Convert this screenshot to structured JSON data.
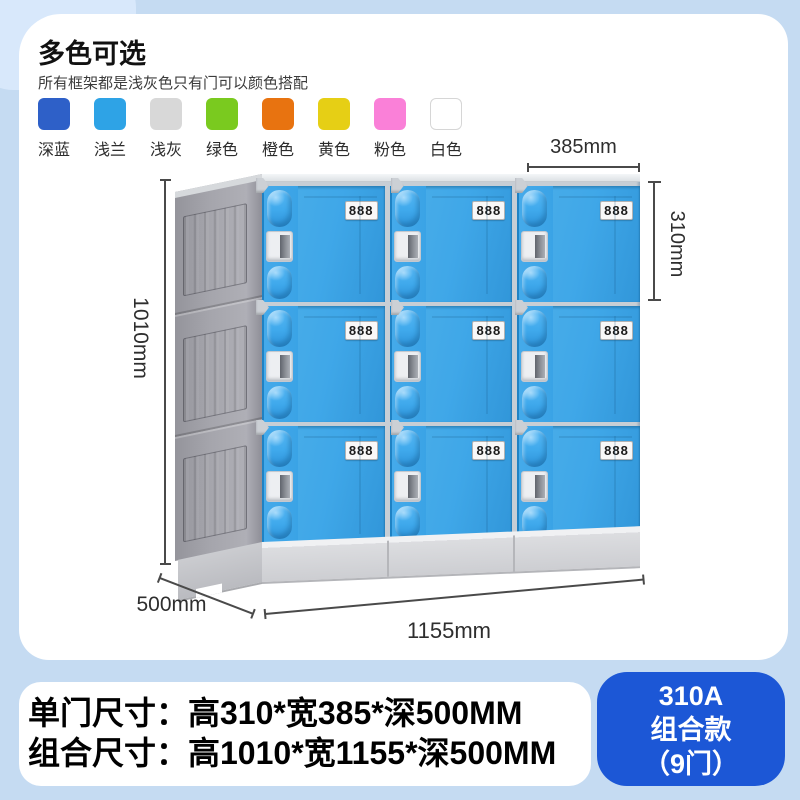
{
  "page": {
    "background": "#c5dbf2"
  },
  "colors_section": {
    "title": "多色可选",
    "subtitle": "所有框架都是浅灰色只有门可以颜色搭配",
    "swatches": [
      {
        "label": "深蓝",
        "color": "#2e60c8"
      },
      {
        "label": "浅兰",
        "color": "#2ea3e6"
      },
      {
        "label": "浅灰",
        "color": "#d8d8d8"
      },
      {
        "label": "绿色",
        "color": "#7aca1f"
      },
      {
        "label": "橙色",
        "color": "#e87310"
      },
      {
        "label": "黄色",
        "color": "#e6cf15"
      },
      {
        "label": "粉色",
        "color": "#fa80d8"
      },
      {
        "label": "白色",
        "color": "#ffffff"
      }
    ]
  },
  "locker": {
    "rows": 3,
    "columns": 3,
    "door_label": "888",
    "door_color": "#3fa7e8",
    "frame_color": "#a3a3aa",
    "dimensions": {
      "door_width": "385mm",
      "door_height": "310mm",
      "total_height": "1010mm",
      "depth": "500mm",
      "total_width": "1155mm"
    }
  },
  "specs": {
    "single_door": "单门尺寸：高310*宽385*深500MM",
    "combined": "组合尺寸：高1010*宽1155*深500MM"
  },
  "badge": {
    "model": "310A",
    "style": "组合款",
    "doors": "（9门）",
    "color": "#1c57d6"
  }
}
